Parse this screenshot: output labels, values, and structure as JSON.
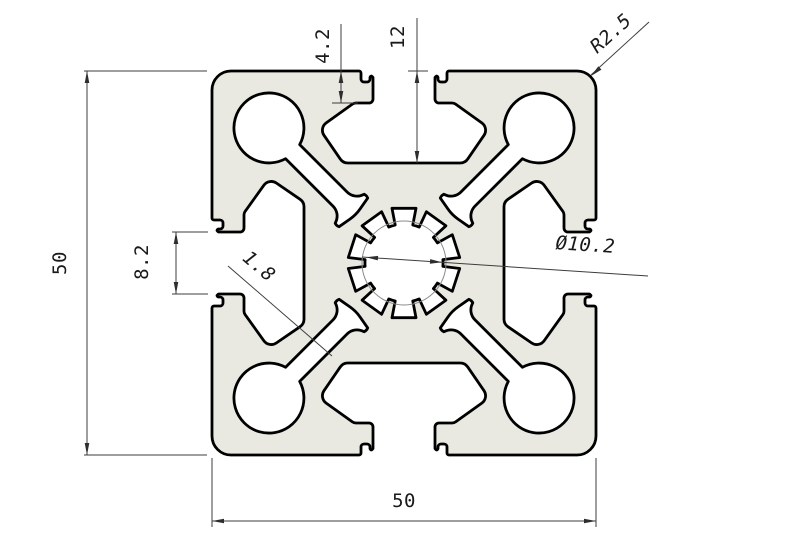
{
  "drawing": {
    "type": "technical-cad-drawing",
    "subject": "aluminum-extrusion-t-slot-profile-cross-section",
    "dimensions": {
      "height": "50",
      "width": "50",
      "slot_opening": "8.2",
      "web_thickness": "1.8",
      "lip_depth": "4.2",
      "slot_depth": "12",
      "corner_radius": "R2.5",
      "center_bore": "Ø10.2"
    },
    "colors": {
      "material_fill": "#e9e9e2",
      "outline": "#000000",
      "dimension_lines": "#3c3c3c",
      "background": "#ffffff"
    }
  }
}
